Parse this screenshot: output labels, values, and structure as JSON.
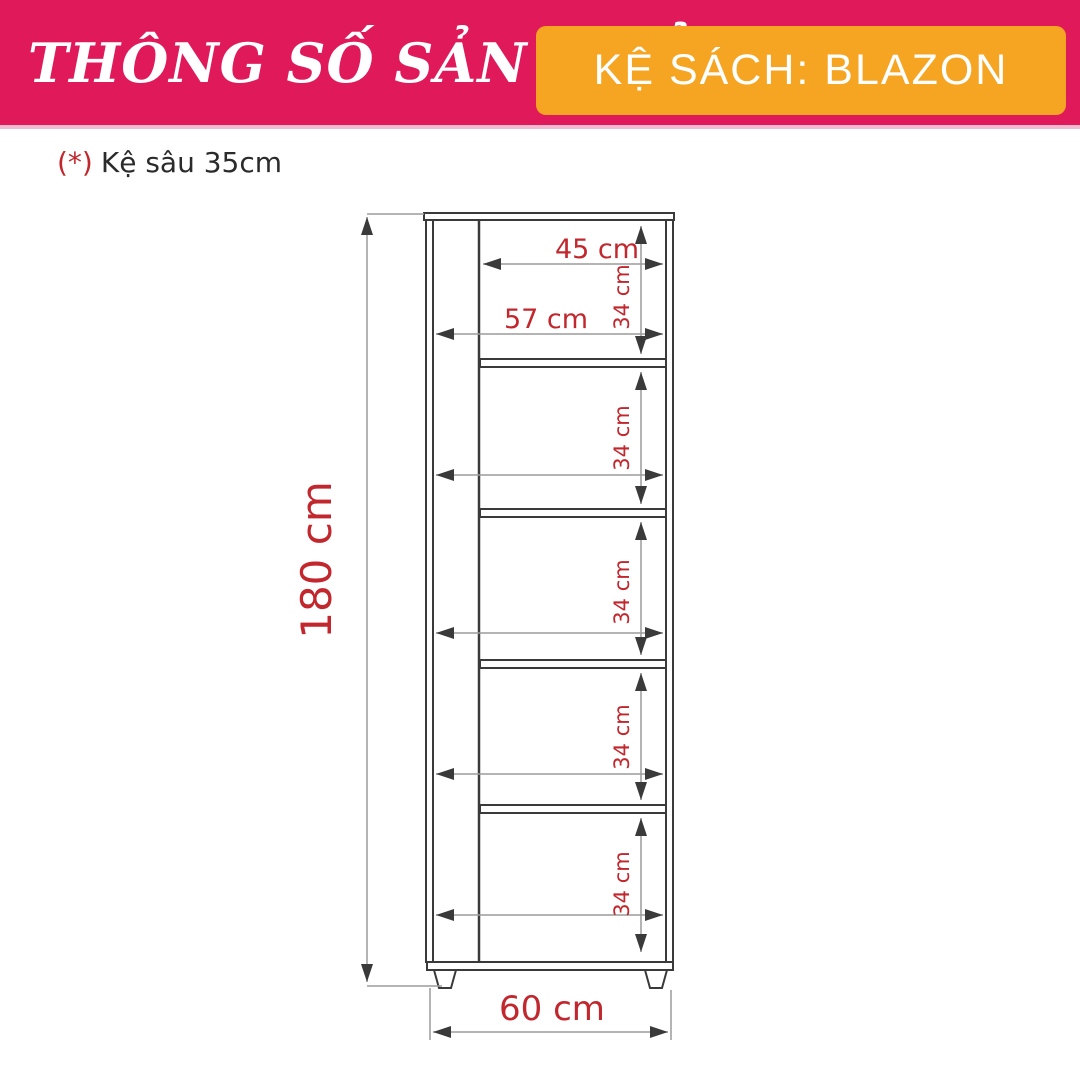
{
  "header": {
    "title": "THÔNG SỐ SẢN PHẨM",
    "badge": "KỆ SÁCH: BLAZON"
  },
  "note": {
    "marker": "(*)",
    "text": "Kệ sâu 35cm"
  },
  "diagram": {
    "product": "bookshelf front-view technical drawing",
    "labels": {
      "height": "180 cm",
      "outer_width": "60 cm",
      "top_inner_width": "45 cm",
      "inner_width": "57 cm",
      "shelf_1": "34 cm",
      "shelf_2": "34 cm",
      "shelf_3": "34 cm",
      "shelf_4": "34 cm",
      "shelf_5": "34 cm"
    }
  },
  "colors": {
    "header_bg": "#E0195B",
    "badge_bg": "#F6A523",
    "dimension_text": "#C1272D",
    "outline": "#3A3A3A",
    "dimension_line": "#9B9B9B"
  }
}
